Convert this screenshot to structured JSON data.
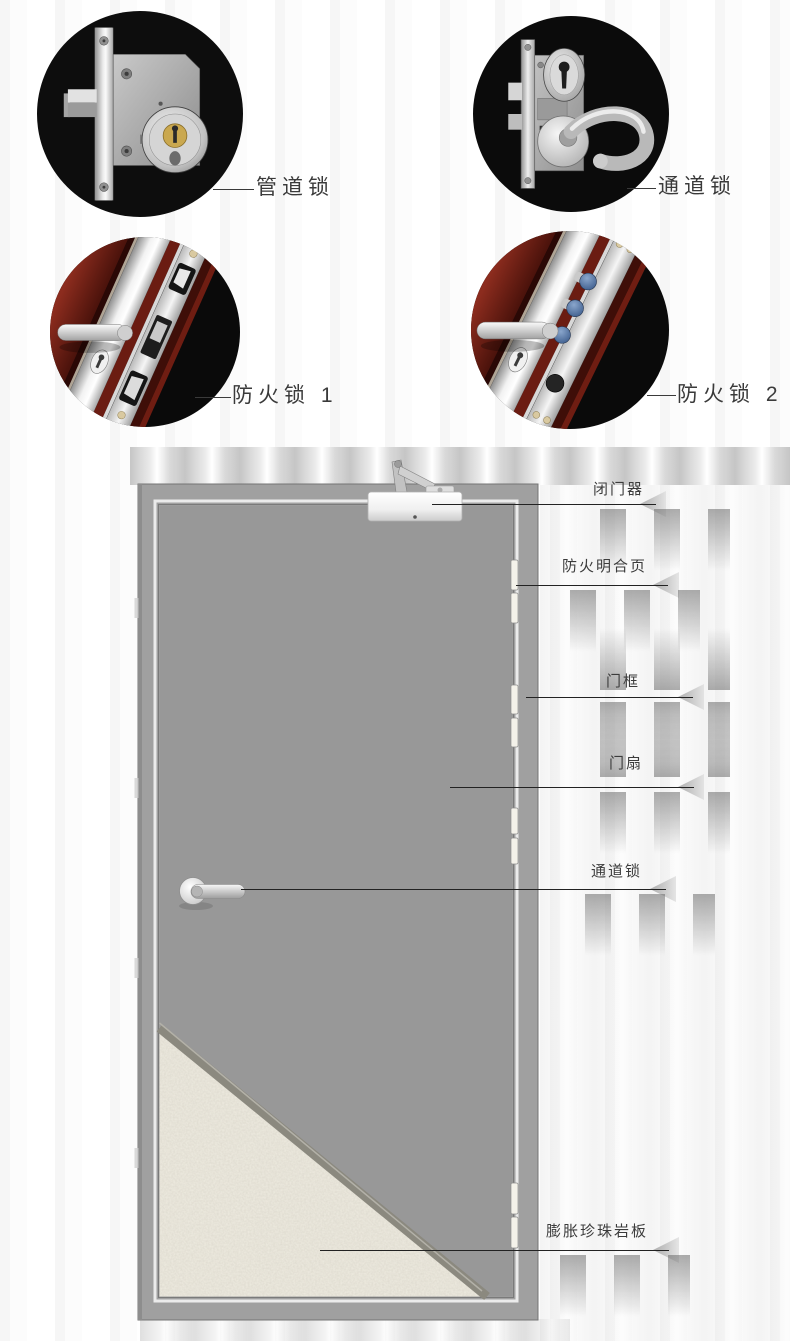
{
  "figures": {
    "pipe_lock": {
      "label": "管道锁"
    },
    "passage_lock": {
      "label": "通道锁"
    },
    "fire_lock_1": {
      "label": "防火锁 1"
    },
    "fire_lock_2": {
      "label": "防火锁 2"
    }
  },
  "door": {
    "labels": {
      "closer": "闭门器",
      "hinge": "防火明合页",
      "frame": "门框",
      "leaf": "门扇",
      "lock": "通道锁",
      "perlite": "膨胀珍珠岩板"
    }
  },
  "colors": {
    "background": "#ffffff",
    "circle_background": "#0d0d0d",
    "door_frame_gray": "#a0a0a0",
    "door_leaf_gray": "#989898",
    "perlite_board": "#efece1",
    "fire_door_red": "#6f1d14",
    "steel": "#c9c9c9",
    "label_text": "#3a3a3a",
    "leader_line": "#222222"
  }
}
